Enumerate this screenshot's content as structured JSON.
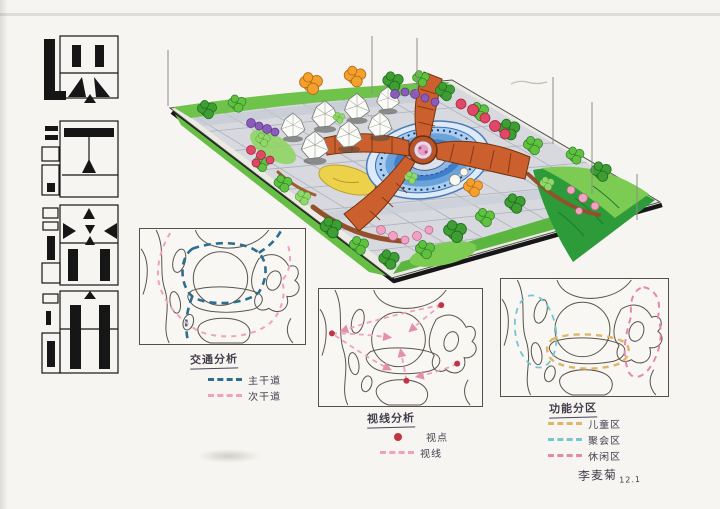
{
  "page": {
    "background": "#f6f5f1",
    "paper_edge": "#d8d6d0"
  },
  "calligraphy_title": {
    "text": "快速设计",
    "chars": [
      "快",
      "速",
      "设",
      "计"
    ],
    "ink_color": "#161616",
    "style": "geometric block calligraphy, vertical"
  },
  "masterplan": {
    "type": "hand-rendered aerial perspective of park masterplan",
    "colors": {
      "lawn": "#63bd41",
      "dark_lawn": "#2e9b3a",
      "paving": "#d7d9df",
      "water": "#3f7ec8",
      "pinwheel": "#cc5f2e",
      "sand": "#ecd24a",
      "orange_tree": "#f59f2d",
      "purple_shrub": "#8a5cb8",
      "pink_flower": "#f08db2",
      "tent": "#fbfbf8"
    }
  },
  "diagrams": [
    {
      "id": "traffic",
      "title": "交通分析",
      "legend": [
        {
          "label": "主干道",
          "color": "#2e6d8e",
          "swatch": "dash"
        },
        {
          "label": "次干道",
          "color": "#efa2bc",
          "swatch": "dash"
        }
      ]
    },
    {
      "id": "sightline",
      "title": "视线分析",
      "legend": [
        {
          "label": "视点",
          "color": "#c23444",
          "swatch": "dot"
        },
        {
          "label": "视线",
          "color": "#efa2bc",
          "swatch": "dash"
        }
      ]
    },
    {
      "id": "zoning",
      "title": "功能分区",
      "legend": [
        {
          "label": "儿童区",
          "color": "#dfb668",
          "swatch": "dash"
        },
        {
          "label": "聚会区",
          "color": "#79c5d2",
          "swatch": "dash"
        },
        {
          "label": "休闲区",
          "color": "#e589ad",
          "swatch": "dash"
        }
      ]
    }
  ],
  "signature": {
    "name": "李麦菊",
    "date": "12.1"
  }
}
